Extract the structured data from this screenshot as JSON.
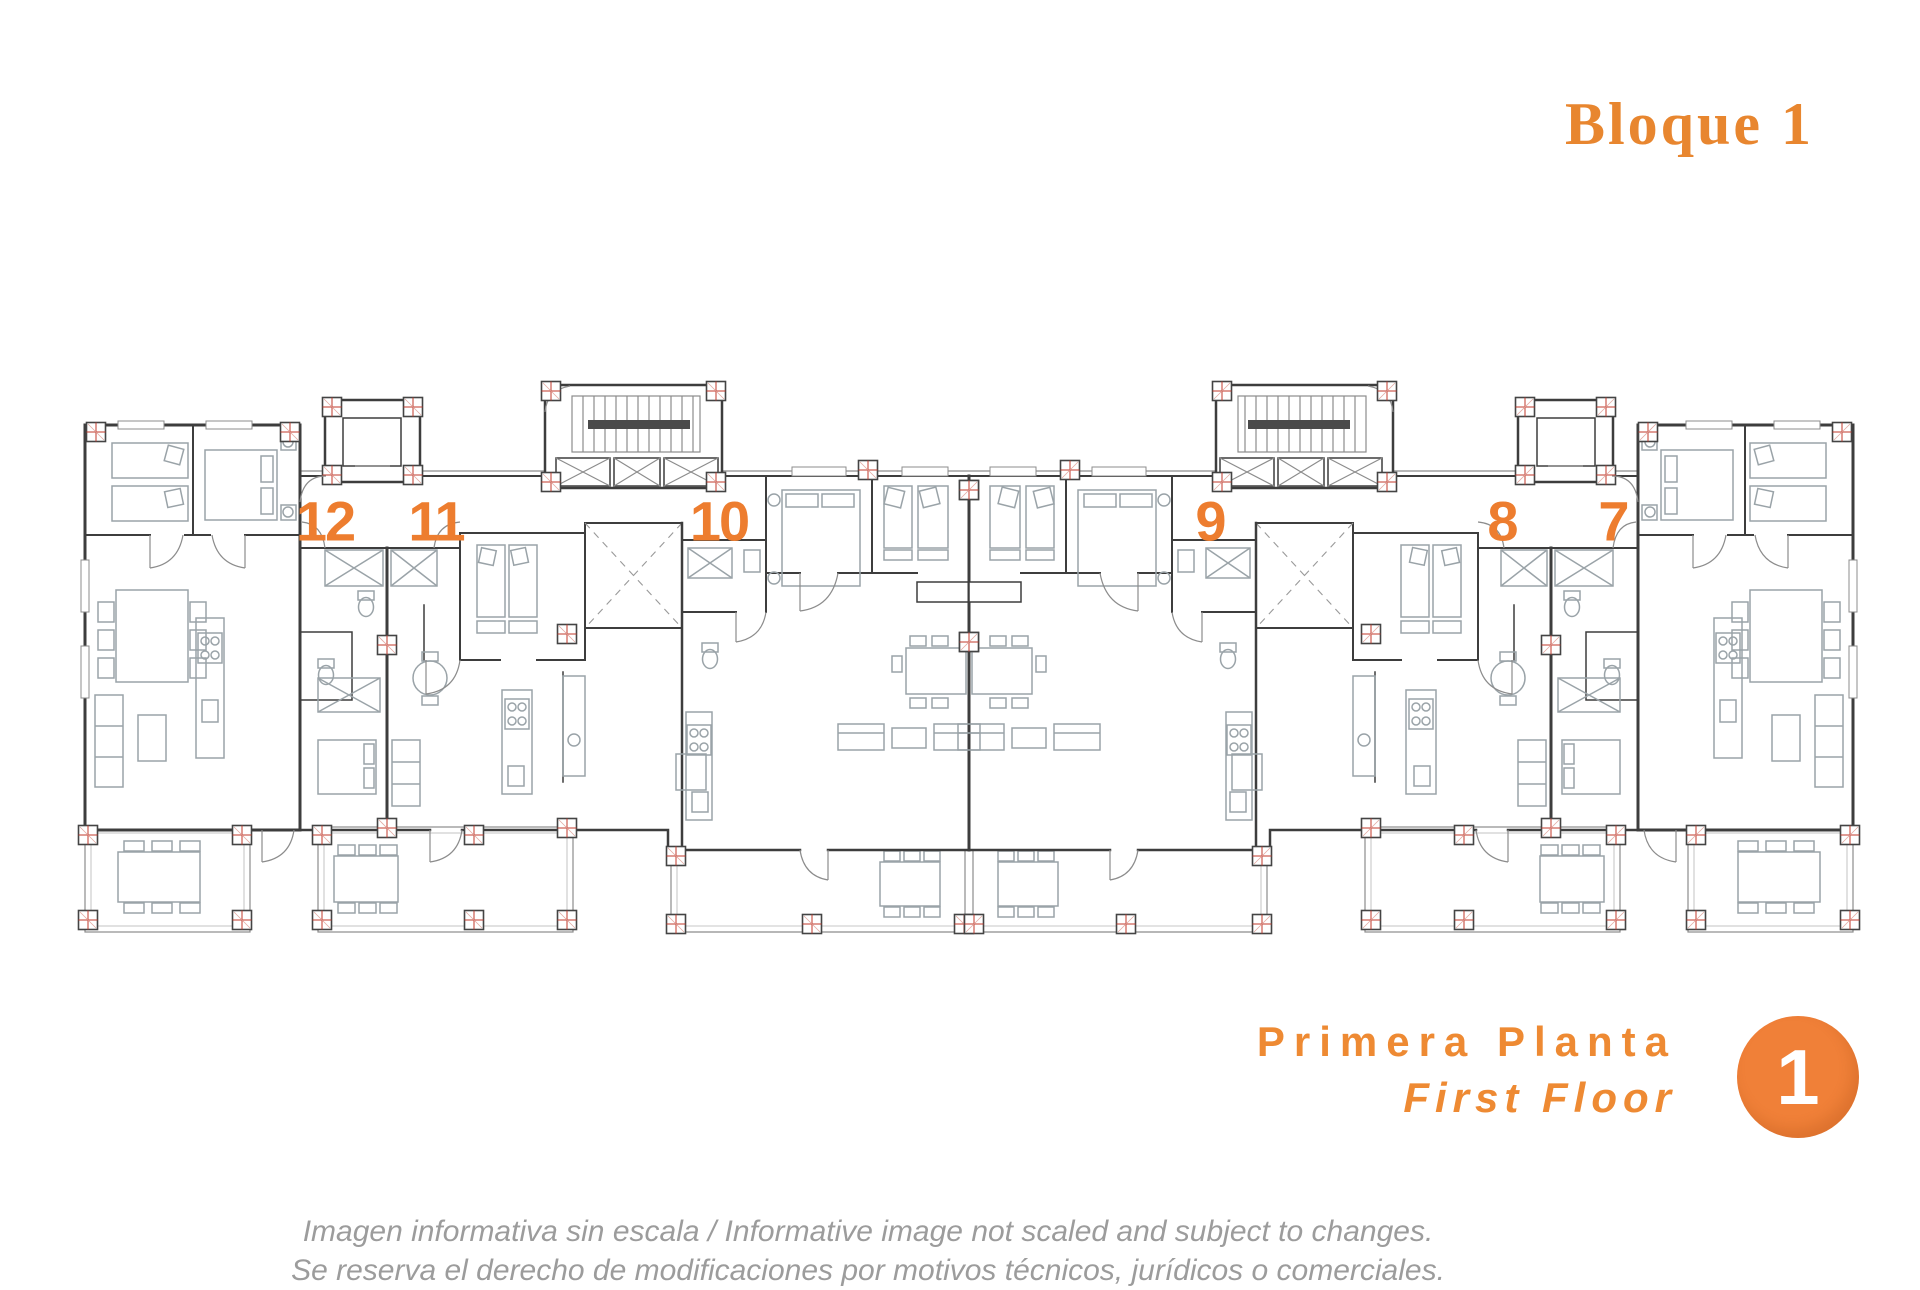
{
  "title": {
    "text": "Bloque 1"
  },
  "plan": {
    "units": [
      {
        "number": "12"
      },
      {
        "number": "11"
      },
      {
        "number": "10"
      },
      {
        "number": "9"
      },
      {
        "number": "8"
      },
      {
        "number": "7"
      }
    ]
  },
  "floor": {
    "label_es": "Primera Planta",
    "label_en": "First Floor",
    "badge_number": "1"
  },
  "footer": {
    "line1": "Imagen informativa sin escala /  Informative image not scaled and subject to changes.",
    "line2": "Se reserva el derecho de modificaciones por motivos técnicos, jurídicos o comerciales."
  },
  "colors": {
    "title_orange": "#E8862F",
    "unit_number_orange": "#ED7D2F",
    "floor_label_orange": "#EE8A33",
    "badge_orange": "#F08038",
    "wall_gray": "#3D3D3D",
    "furniture_gray": "#9AA3A8",
    "column_marker_red": "#C0392B",
    "footer_gray": "#9C9C9C"
  }
}
